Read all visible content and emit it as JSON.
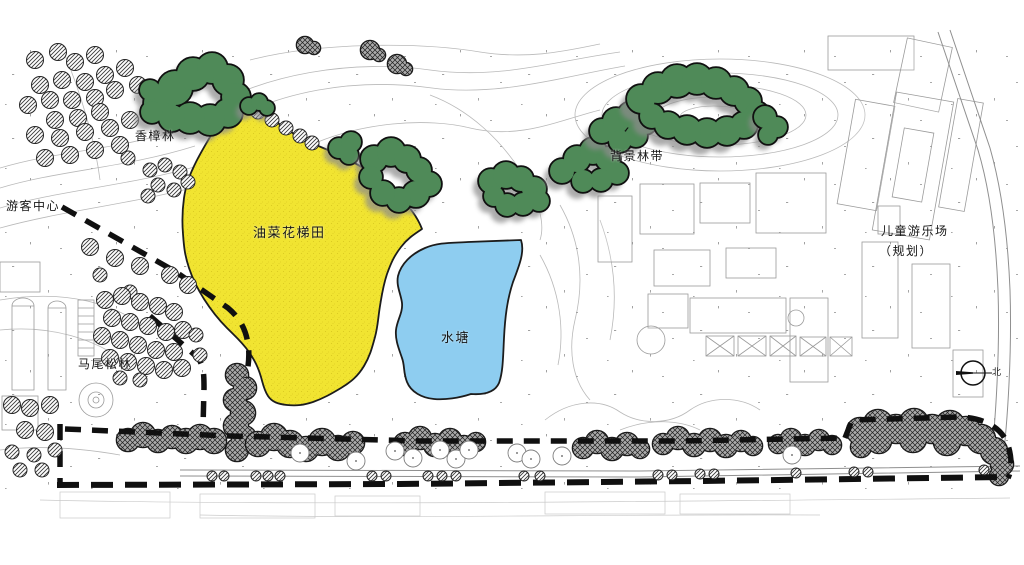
{
  "map": {
    "title": "landscape-site-plan",
    "labels": {
      "camphor_forest": "香樟林",
      "visitor_center": "游客中心",
      "rapeseed_terraces": "油菜花梯田",
      "pond": "水塘",
      "background_forest_belt": "背景林带",
      "children_playground_line1": "儿童游乐场",
      "children_playground_line2": "（规划）",
      "masson_pine_forest": "马尾松林",
      "north": "北"
    }
  },
  "colors": {
    "c-field": "#f1e431",
    "c-field-dot": "#d8c51e",
    "c-pond": "#8ecdf0",
    "c-green": "#4f8a58",
    "c-line": "#b9b9b9",
    "c-bound": "#101010"
  }
}
